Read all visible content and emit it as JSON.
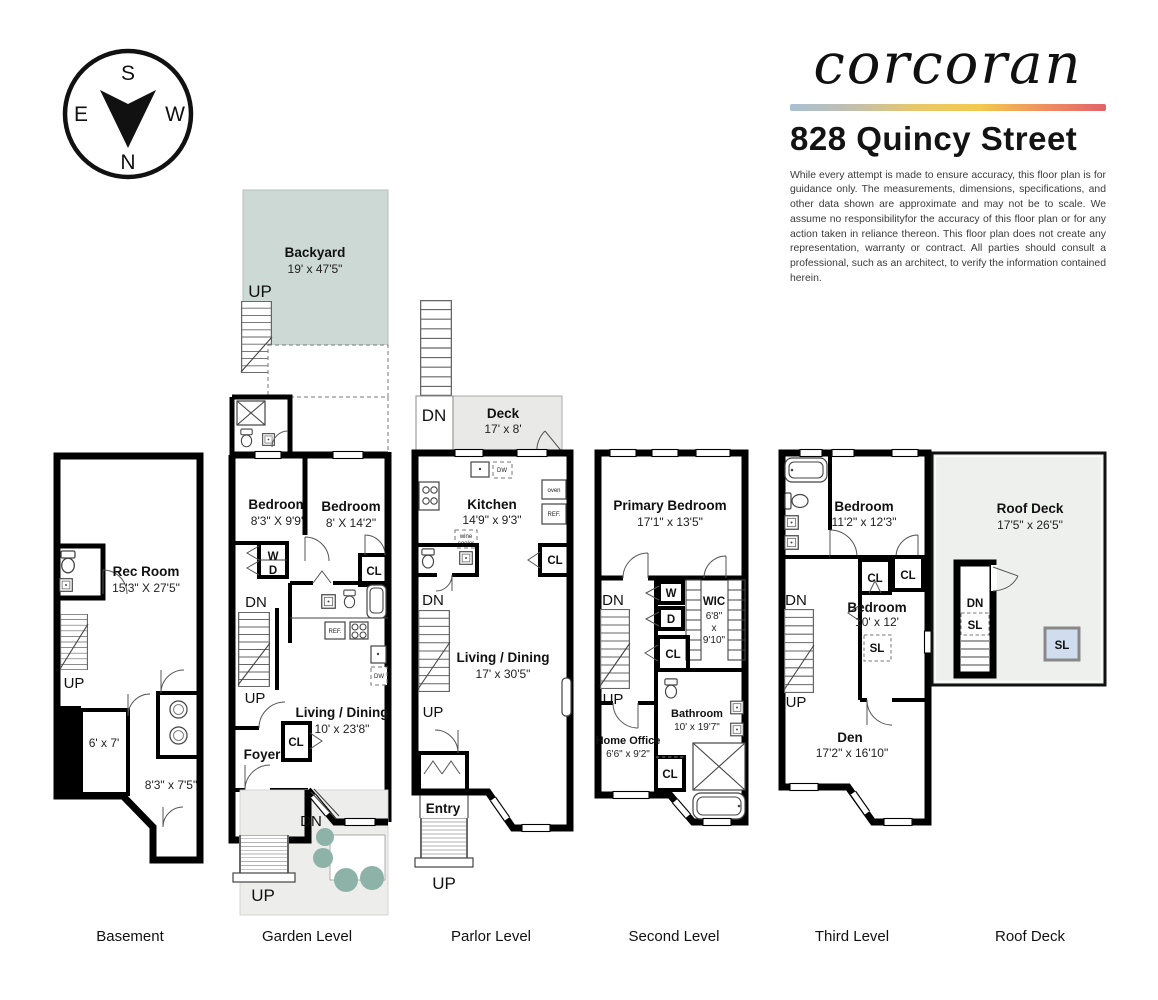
{
  "header": {
    "brand": "corcoran",
    "address": "828 Quincy Street",
    "disclaimer": "While every attempt is made to ensure accuracy, this floor plan is for guidance only. The measurements, dimensions, specifications, and other data shown are approximate and may not be to scale. We assume no responsibilityfor the accuracy of this floor plan or for any action taken in reliance thereon. This floor plan does not create any representation, warranty or contract. All parties should consult a professional, such as an architect, to verify the information contained herein."
  },
  "compass": {
    "n": "N",
    "s": "S",
    "e": "E",
    "w": "W"
  },
  "colors": {
    "backyard": "#cdd9d4",
    "deck": "#e9eae8",
    "frontyard": "#ededeb",
    "roofdeck": "#eef0ee",
    "skylight": "#cfddee",
    "plant": "#8db2a7",
    "gradient": [
      "#a9bfd3",
      "#c2bfae",
      "#e8c76a",
      "#f3c94e",
      "#ee9160",
      "#e2626b"
    ]
  },
  "floors": {
    "basement": {
      "title": "Basement",
      "rec_room_name": "Rec Room",
      "rec_room_dims": "15'3\" X 27'5\"",
      "up": "UP",
      "room1_dims": "6' x 7'",
      "room2_dims": "8'3\" x 7'5\""
    },
    "garden": {
      "title": "Garden Level",
      "backyard_name": "Backyard",
      "backyard_dims": "19' x 47'5\"",
      "up_backyard": "UP",
      "bedroom1_name": "Bedroom",
      "bedroom1_dims": "8'3\" X 9'9\"",
      "bedroom2_name": "Bedroom",
      "bedroom2_dims": "8' X 14'2\"",
      "washer": "W",
      "dryer": "D",
      "closet1": "CL",
      "dn_hall": "DN",
      "up_stairs": "UP",
      "ref": "REF.",
      "dw": "DW",
      "living_name": "Living / Dining",
      "living_dims": "10' x 23'8\"",
      "closet2": "CL",
      "foyer": "Foyer",
      "dn_entry": "DN",
      "up_entry": "UP"
    },
    "parlor": {
      "title": "Parlor Level",
      "dn_deck": "DN",
      "deck_name": "Deck",
      "deck_dims": "17' x 8'",
      "kitchen_name": "Kitchen",
      "kitchen_dims": "14'9\" x 9'3\"",
      "dw": "DW",
      "oven": "oven",
      "ref": "REF.",
      "wine1": "wine",
      "wine2": "cooler",
      "closet": "CL",
      "dn": "DN",
      "up": "UP",
      "living_name": "Living / Dining",
      "living_dims": "17' x 30'5\"",
      "entry": "Entry",
      "up_entry": "UP"
    },
    "second": {
      "title": "Second Level",
      "primary_name": "Primary Bedroom",
      "primary_dims": "17'1\" x 13'5\"",
      "dn": "DN",
      "up": "UP",
      "washer": "W",
      "dryer": "D",
      "wic_name": "WIC",
      "wic_dim1": "6'8\"",
      "wic_x": "x",
      "wic_dim2": "9'10\"",
      "closet1": "CL",
      "home_office_name": "Home Office",
      "home_office_dims": "6'6\" x 9'2\"",
      "closet2": "CL",
      "bathroom_name": "Bathroom",
      "bathroom_dims": "10' x 19'7\""
    },
    "third": {
      "title": "Third Level",
      "bedroom1_name": "Bedroom",
      "bedroom1_dims": "11'2\" x 12'3\"",
      "closet1": "CL",
      "closet2": "CL",
      "bedroom2_name": "Bedroom",
      "bedroom2_dims": "10' x 12'",
      "skylight": "SL",
      "dn": "DN",
      "up": "UP",
      "den_name": "Den",
      "den_dims": "17'2\" x 16'10\""
    },
    "roof": {
      "title": "Roof Deck",
      "name": "Roof Deck",
      "dims": "17'5\" x 26'5\"",
      "dn": "DN",
      "sl_stairs": "SL",
      "sl_deck": "SL"
    }
  }
}
